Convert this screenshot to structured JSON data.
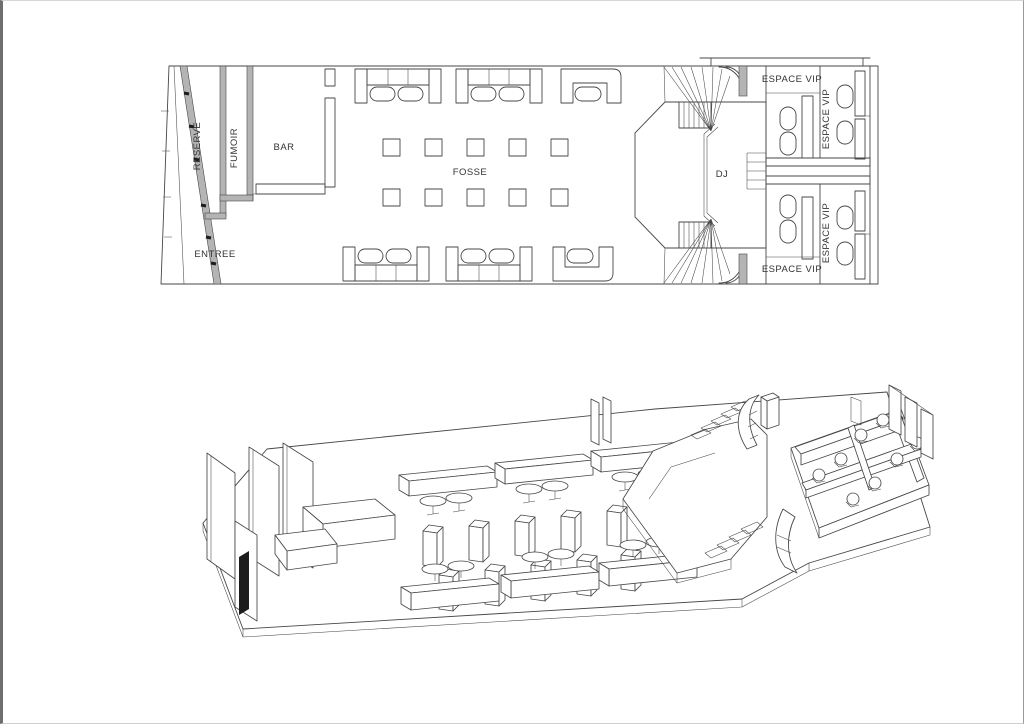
{
  "colors": {
    "line": "#474747",
    "wall": "#b4b4b4",
    "text": "#333333",
    "door": "#1c1c1c",
    "bg": "#ffffff"
  },
  "floor_plan": {
    "labels": {
      "reserve": "RESERVE",
      "fumoir": "FUMOIR",
      "bar": "BAR",
      "entree": "ENTREE",
      "fosse": "FOSSE",
      "dj": "DJ",
      "vip_top": "ESPACE VIP",
      "vip_bottom": "ESPACE VIP",
      "vip_right_top": "ESPACE VIP",
      "vip_right_bottom": "ESPACE VIP"
    }
  }
}
